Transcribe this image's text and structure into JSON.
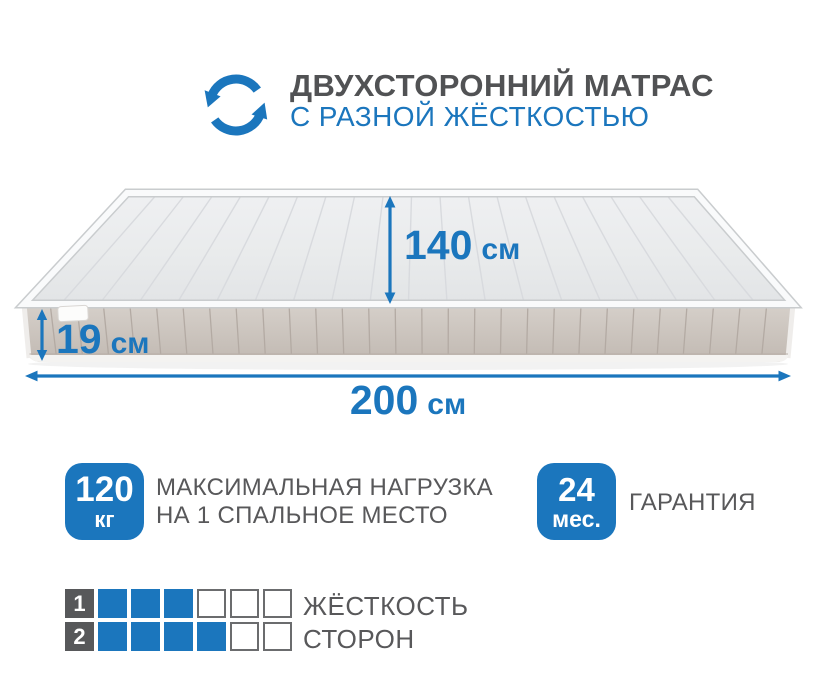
{
  "header": {
    "icon": "two-sided-rotation-icon",
    "title": "ДВУХСТОРОННИЙ МАТРАС",
    "subtitle": "С РАЗНОЙ ЖЁСТКОСТЬЮ"
  },
  "mattress": {
    "illustration": "two-sided mattress, light quilted top, beige ribbed side, white tag",
    "dimensions": {
      "depth": {
        "value": "140",
        "unit": "см"
      },
      "height": {
        "value": "19",
        "unit": "см"
      },
      "length": {
        "value": "200",
        "unit": "см"
      }
    }
  },
  "features": {
    "max_load": {
      "value": "120",
      "unit": "кг",
      "label_line1": "МАКСИМАЛЬНАЯ НАГРУЗКА",
      "label_line2": "НА 1 СПАЛЬНОЕ МЕСТО"
    },
    "warranty": {
      "value": "24",
      "unit": "мес.",
      "label": "ГАРАНТИЯ"
    }
  },
  "firmness": {
    "label_line1": "ЖЁСТКОСТЬ",
    "label_line2": "СТОРОН",
    "scale_max": 6,
    "sides": [
      {
        "label": "1",
        "level": 3
      },
      {
        "label": "2",
        "level": 4
      }
    ]
  },
  "colors": {
    "accent_blue": "#1b76bd",
    "text_gray": "#58585a",
    "label_dark": "#57585a"
  }
}
